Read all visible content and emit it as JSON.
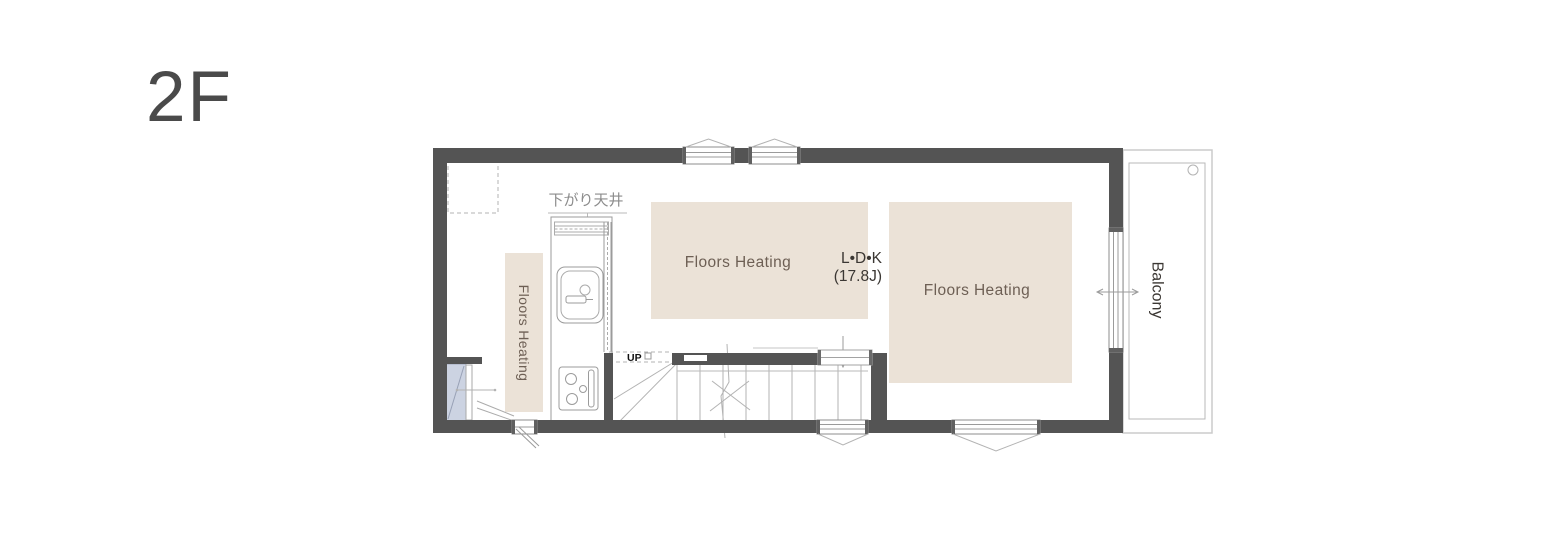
{
  "title": "2F",
  "plan": {
    "kitchen": {
      "lowered_ceiling_label": "下がり天井",
      "heating_strip_label": "Floors Heating"
    },
    "living": {
      "heating_label": "Floors Heating",
      "room_name": "L•D•K",
      "room_size": "(17.8J)"
    },
    "right_room": {
      "heating_label": "Floors Heating"
    },
    "stairs": {
      "direction_label": "UP"
    },
    "balcony": {
      "label": "Balcony"
    }
  },
  "colors": {
    "wall": "#545454",
    "floor_heating_fill": "#ebe2d7",
    "floor_heating_text": "#6d5f54",
    "door_fill": "#ccd3e2",
    "title_text": "#4a4a4a",
    "muted_text": "#8c8c8c",
    "dark_text": "#3b3733",
    "fixture_line": "#9b9b9b",
    "light_line": "#b3b3b3",
    "window_frame": "#8e8e8e"
  }
}
